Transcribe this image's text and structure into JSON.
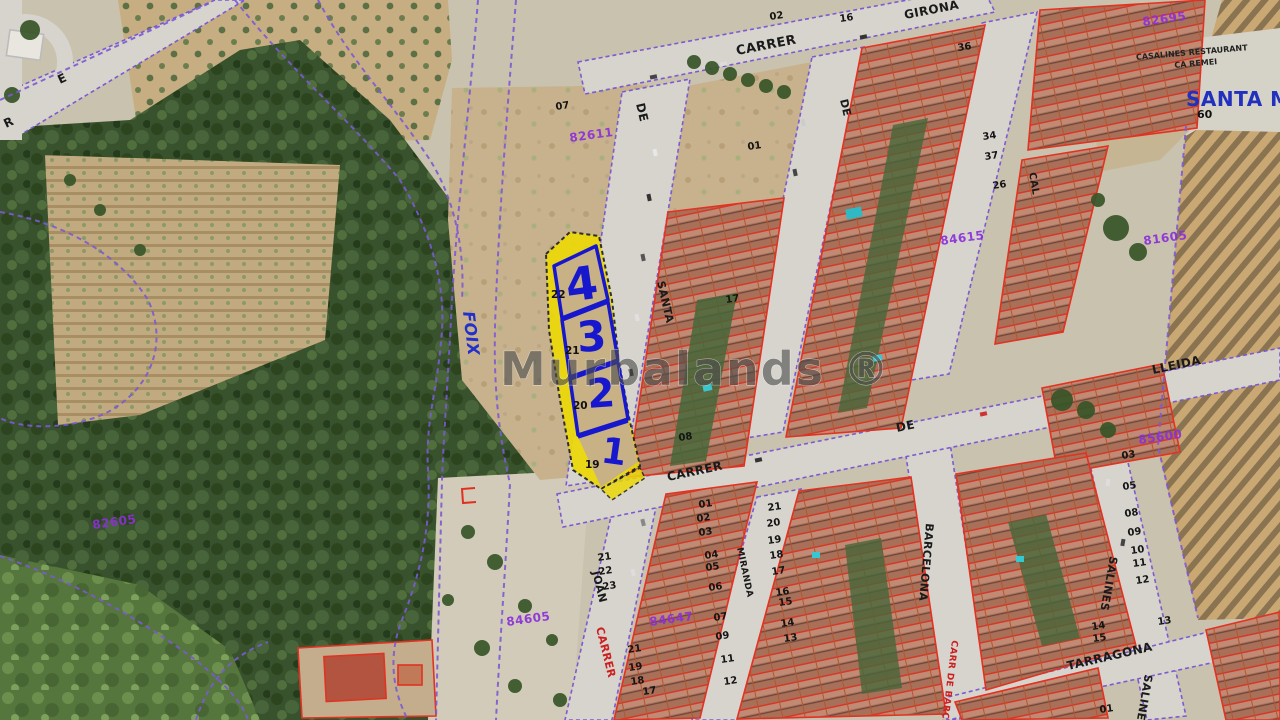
{
  "map": {
    "watermark": "Murbalands ®",
    "santa_m": {
      "label": "SANTA M",
      "number": "60"
    },
    "restaurant": {
      "line1": "CASALINES RESTAURANT",
      "line2": "CA REMEI"
    },
    "highlight_plots": [
      {
        "plot": "4",
        "ref": "22"
      },
      {
        "plot": "3",
        "ref": "21"
      },
      {
        "plot": "2",
        "ref": "20"
      },
      {
        "plot": "1",
        "ref": "19"
      }
    ],
    "street_labels": [
      {
        "text": "CARRER",
        "x": 737,
        "y": 55,
        "rot": -11,
        "size": 13,
        "color": "#1a1a1a"
      },
      {
        "text": "GIRONA",
        "x": 905,
        "y": 19,
        "rot": -11,
        "size": 12,
        "color": "#1a1a1a"
      },
      {
        "text": "DE",
        "x": 636,
        "y": 104,
        "rot": 77,
        "size": 12,
        "color": "#1a1a1a"
      },
      {
        "text": "DE",
        "x": 840,
        "y": 100,
        "rot": 77,
        "size": 11,
        "color": "#1a1a1a"
      },
      {
        "text": "SANTA",
        "x": 657,
        "y": 282,
        "rot": 77,
        "size": 11,
        "color": "#1a1a1a"
      },
      {
        "text": "CAL",
        "x": 1029,
        "y": 173,
        "rot": 80,
        "size": 10,
        "color": "#1a1a1a"
      },
      {
        "text": "CARRER",
        "x": 668,
        "y": 481,
        "rot": -12,
        "size": 12,
        "color": "#1a1a1a"
      },
      {
        "text": "DE",
        "x": 897,
        "y": 432,
        "rot": -12,
        "size": 12,
        "color": "#1a1a1a"
      },
      {
        "text": "LLEIDA",
        "x": 1153,
        "y": 374,
        "rot": -12,
        "size": 12,
        "color": "#1a1a1a"
      },
      {
        "text": "JOAN",
        "x": 592,
        "y": 572,
        "rot": 76,
        "size": 11,
        "color": "#1a1a1a"
      },
      {
        "text": "CARRER",
        "x": 596,
        "y": 628,
        "rot": 76,
        "size": 11,
        "color": "#cc2020"
      },
      {
        "text": "MIRANDA",
        "x": 737,
        "y": 548,
        "rot": 78,
        "size": 9,
        "color": "#1a1a1a"
      },
      {
        "text": "BARCELONA",
        "x": 926,
        "y": 523,
        "rot": 95,
        "size": 11,
        "color": "#1a1a1a"
      },
      {
        "text": "CARR DE BARCELONA",
        "x": 952,
        "y": 640,
        "rot": 97,
        "size": 9,
        "color": "#cc2020"
      },
      {
        "text": "SALINES",
        "x": 1110,
        "y": 556,
        "rot": 100,
        "size": 11,
        "color": "#1a1a1a"
      },
      {
        "text": "SALINES",
        "x": 1145,
        "y": 674,
        "rot": 100,
        "size": 11,
        "color": "#1a1a1a"
      },
      {
        "text": "TARRAGONA",
        "x": 1068,
        "y": 670,
        "rot": -13,
        "size": 12,
        "color": "#1a1a1a"
      },
      {
        "text": "FOIX",
        "x": 463,
        "y": 312,
        "rot": 83,
        "size": 16,
        "color": "#2230cc",
        "style": "italic"
      },
      {
        "text": "E",
        "x": 60,
        "y": 84,
        "rot": -25,
        "size": 12,
        "color": "#1a1a1a"
      },
      {
        "text": "R",
        "x": 6,
        "y": 128,
        "rot": -25,
        "size": 12,
        "color": "#1a1a1a"
      }
    ],
    "block_codes": [
      {
        "text": "82605",
        "x": 93,
        "y": 529
      },
      {
        "text": "82611",
        "x": 570,
        "y": 142
      },
      {
        "text": "84605",
        "x": 507,
        "y": 626
      },
      {
        "text": "84647",
        "x": 650,
        "y": 626
      },
      {
        "text": "84615",
        "x": 941,
        "y": 245
      },
      {
        "text": "85600",
        "x": 1139,
        "y": 444
      },
      {
        "text": "81605",
        "x": 1144,
        "y": 245
      },
      {
        "text": "82695",
        "x": 1143,
        "y": 26
      }
    ],
    "parcel_numbers": [
      {
        "text": "02",
        "x": 770,
        "y": 20
      },
      {
        "text": "16",
        "x": 840,
        "y": 22
      },
      {
        "text": "36",
        "x": 958,
        "y": 51
      },
      {
        "text": "07",
        "x": 556,
        "y": 110
      },
      {
        "text": "01",
        "x": 748,
        "y": 150
      },
      {
        "text": "17",
        "x": 726,
        "y": 303
      },
      {
        "text": "08",
        "x": 679,
        "y": 441
      },
      {
        "text": "34",
        "x": 983,
        "y": 140
      },
      {
        "text": "37",
        "x": 985,
        "y": 160
      },
      {
        "text": "26",
        "x": 993,
        "y": 189
      },
      {
        "text": "21",
        "x": 598,
        "y": 561
      },
      {
        "text": "22",
        "x": 599,
        "y": 575
      },
      {
        "text": "23",
        "x": 603,
        "y": 590
      },
      {
        "text": "21",
        "x": 628,
        "y": 653
      },
      {
        "text": "19",
        "x": 629,
        "y": 671
      },
      {
        "text": "18",
        "x": 631,
        "y": 685
      },
      {
        "text": "17",
        "x": 643,
        "y": 695
      },
      {
        "text": "01",
        "x": 699,
        "y": 508
      },
      {
        "text": "02",
        "x": 697,
        "y": 522
      },
      {
        "text": "03",
        "x": 699,
        "y": 536
      },
      {
        "text": "04",
        "x": 705,
        "y": 559
      },
      {
        "text": "05",
        "x": 706,
        "y": 571
      },
      {
        "text": "06",
        "x": 709,
        "y": 591
      },
      {
        "text": "07",
        "x": 714,
        "y": 621
      },
      {
        "text": "09",
        "x": 716,
        "y": 640
      },
      {
        "text": "11",
        "x": 721,
        "y": 663
      },
      {
        "text": "12",
        "x": 724,
        "y": 685
      },
      {
        "text": "21",
        "x": 768,
        "y": 511
      },
      {
        "text": "20",
        "x": 767,
        "y": 527
      },
      {
        "text": "19",
        "x": 768,
        "y": 544
      },
      {
        "text": "18",
        "x": 770,
        "y": 559
      },
      {
        "text": "17",
        "x": 772,
        "y": 575
      },
      {
        "text": "16",
        "x": 776,
        "y": 596
      },
      {
        "text": "15",
        "x": 779,
        "y": 606
      },
      {
        "text": "14",
        "x": 781,
        "y": 627
      },
      {
        "text": "13",
        "x": 784,
        "y": 642
      },
      {
        "text": "03",
        "x": 1122,
        "y": 459
      },
      {
        "text": "05",
        "x": 1123,
        "y": 490
      },
      {
        "text": "08",
        "x": 1125,
        "y": 517
      },
      {
        "text": "09",
        "x": 1128,
        "y": 536
      },
      {
        "text": "10",
        "x": 1131,
        "y": 554
      },
      {
        "text": "11",
        "x": 1133,
        "y": 567
      },
      {
        "text": "12",
        "x": 1136,
        "y": 584
      },
      {
        "text": "13",
        "x": 1158,
        "y": 625
      },
      {
        "text": "14",
        "x": 1092,
        "y": 630
      },
      {
        "text": "15",
        "x": 1093,
        "y": 642
      },
      {
        "text": "01",
        "x": 1100,
        "y": 713
      }
    ]
  }
}
